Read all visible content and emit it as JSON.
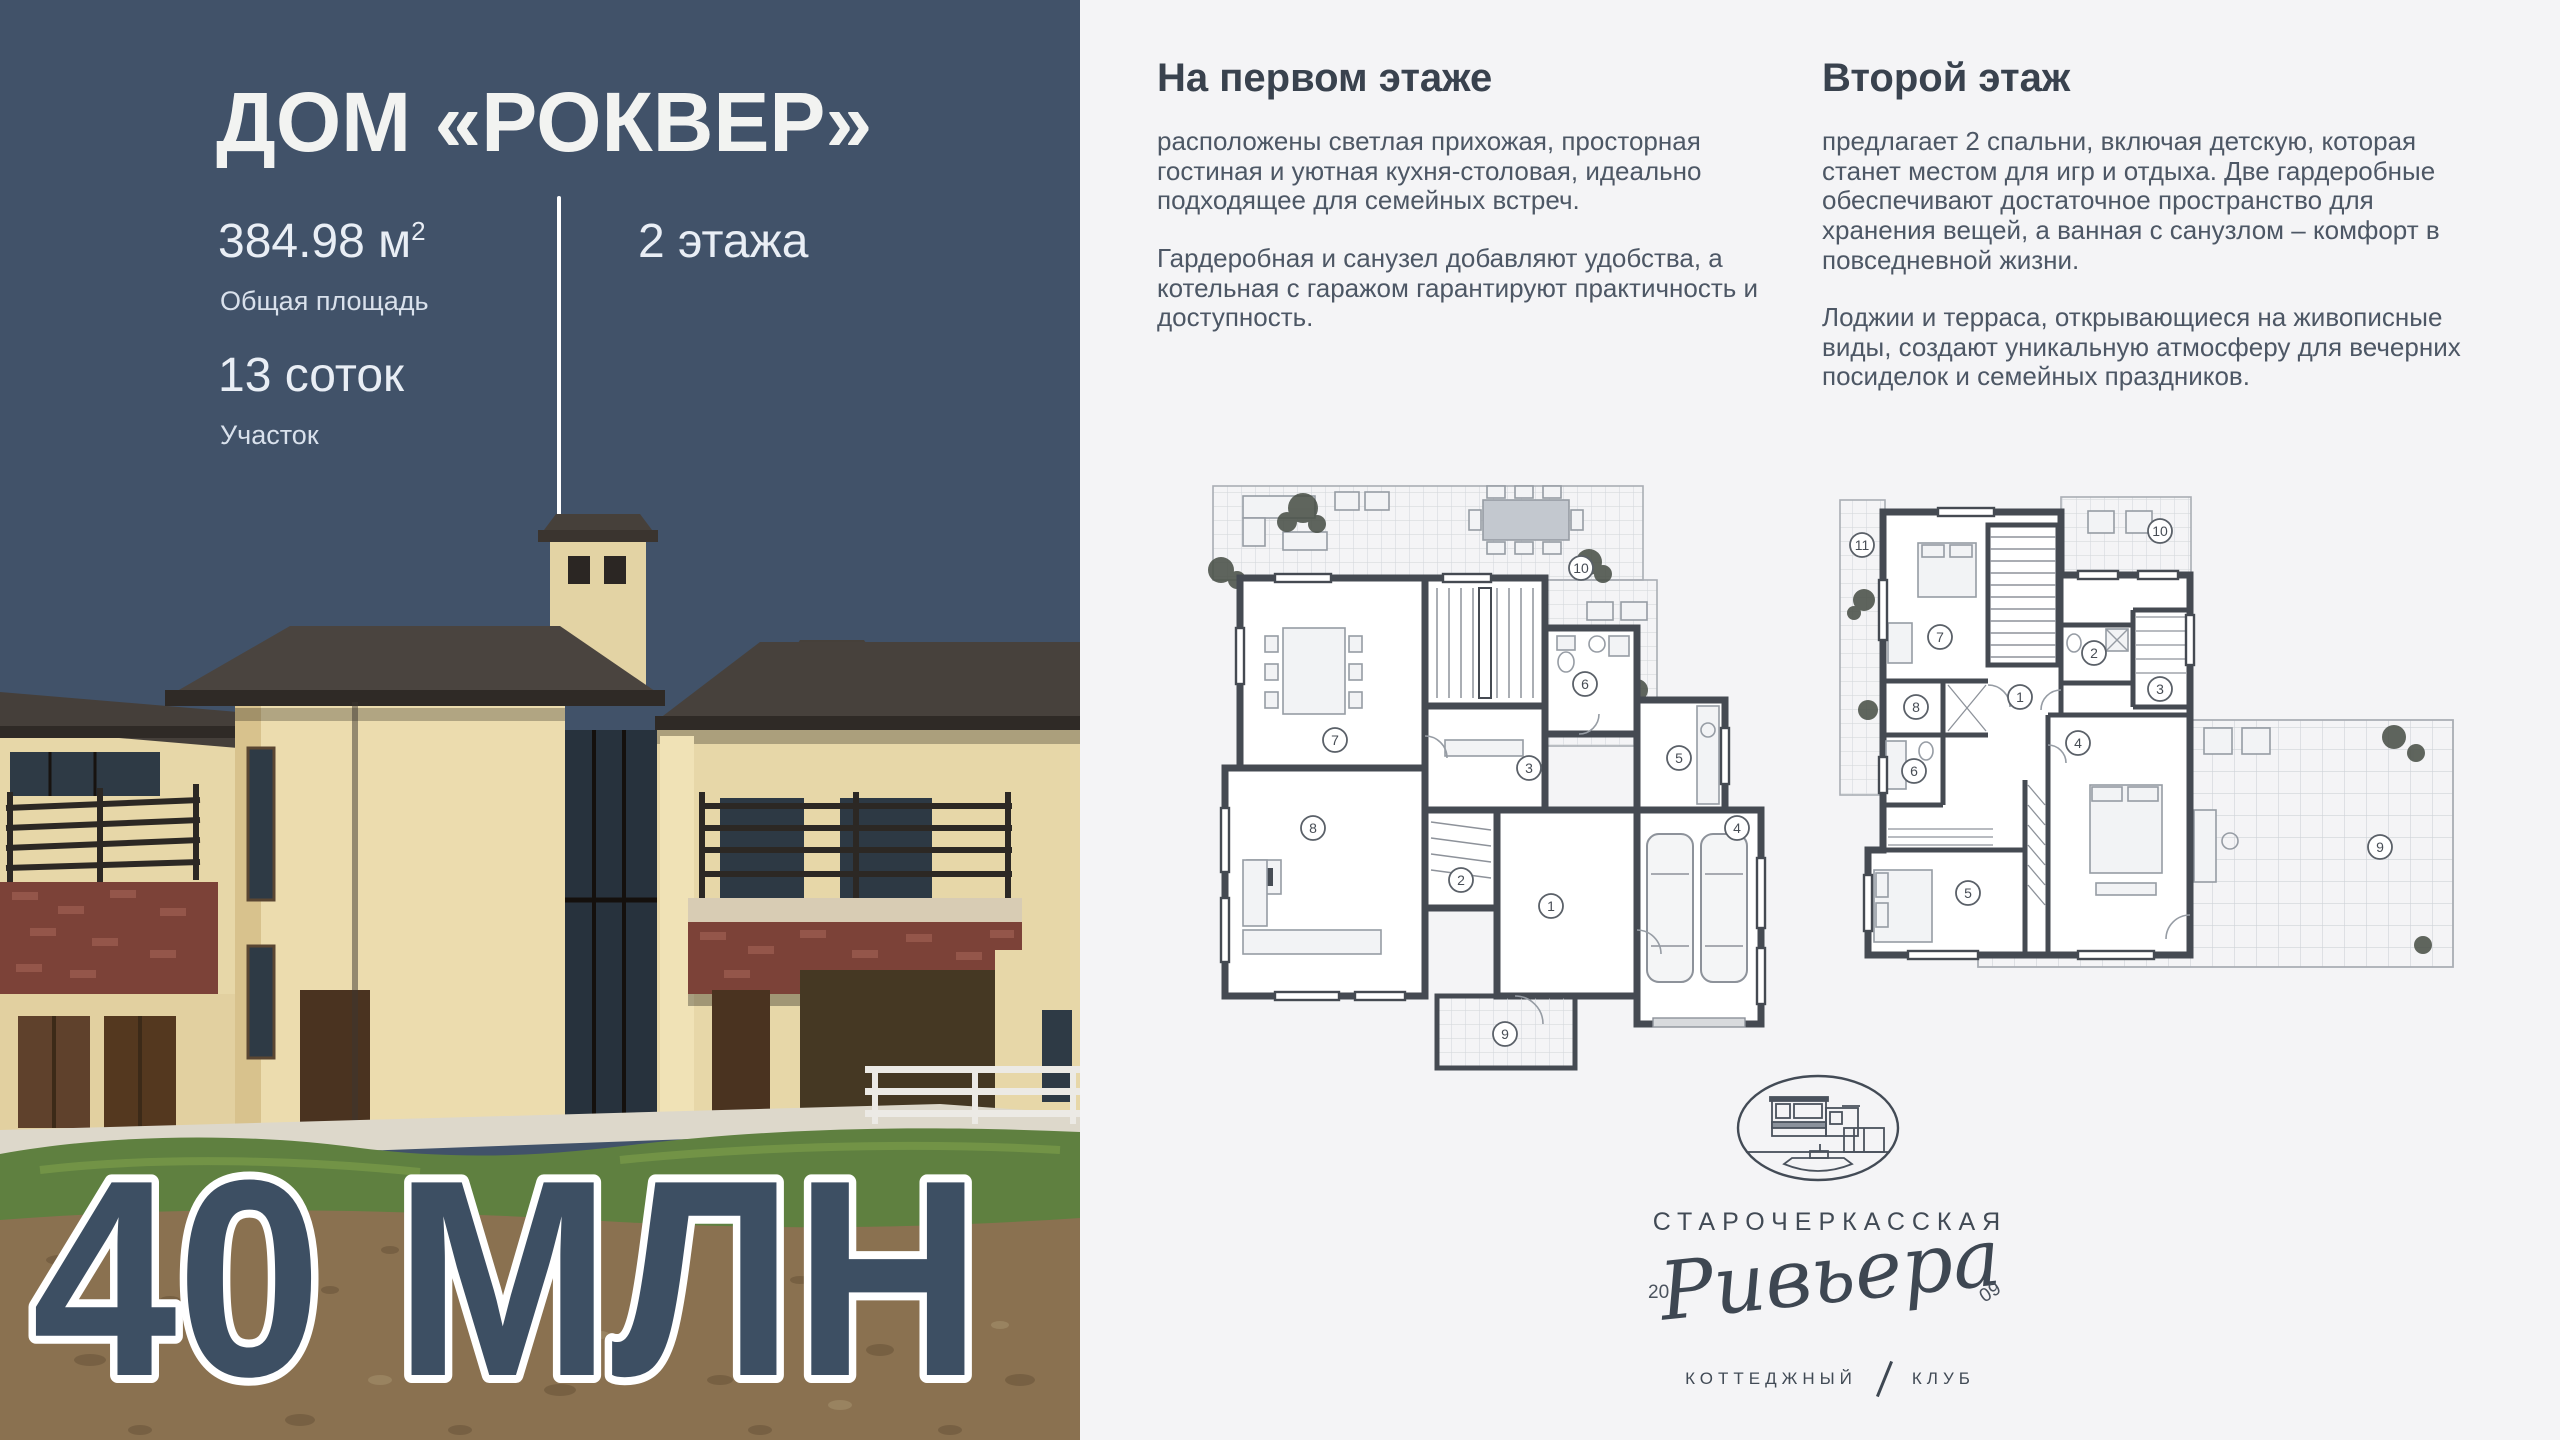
{
  "left_panel": {
    "title": "ДОМ «РОКВЕР»",
    "area_value": "384.98 м",
    "area_sup": "2",
    "area_label": "Общая площадь",
    "floors_value": "2 этажа",
    "plot_value": "13 соток",
    "plot_label": "Участок",
    "price": "40 МЛН"
  },
  "sections": {
    "first_floor": {
      "heading": "На первом этаже",
      "p1": "расположены светлая прихожая, просторная гостиная и уютная кухня-столовая, идеально подходящее для семейных встреч.",
      "p2": "Гардеробная и санузел добавляют удобства, а котельная с гаражом гарантируют практичность и доступность."
    },
    "second_floor": {
      "heading": "Второй этаж",
      "p1": "предлагает 2 спальни, включая детскую, которая станет местом для игр и отдыха. Две гардеробные обеспечивают достаточное пространство для хранения вещей, а ванная с санузлом – комфорт в повседневной жизни.",
      "p2": "Лоджии и терраса, открывающиеся на живописные виды, создают уникальную атмосферу для вечерних посиделок и семейных праздников."
    }
  },
  "plans": {
    "floor1": {
      "rooms": [
        "1",
        "2",
        "3",
        "4",
        "5",
        "6",
        "7",
        "8",
        "9",
        "10"
      ]
    },
    "floor2": {
      "rooms": [
        "1",
        "2",
        "3",
        "4",
        "5",
        "6",
        "7",
        "8",
        "9",
        "10",
        "11"
      ]
    }
  },
  "logo": {
    "estate": "СТАРОЧЕРКАССКАЯ",
    "script": "Ривьера",
    "year_left": "20",
    "year_right": "09",
    "club_left": "КОТТЕДЖНЫЙ",
    "club_right": "КЛУБ"
  },
  "colors": {
    "panel_bg": "#415269",
    "page_bg": "#F4F4F6",
    "price_fill": "#3D4F63",
    "price_stroke": "#FFFFFF",
    "heading": "#39424E",
    "body_text": "#4D5765",
    "plan_wall": "#454A52",
    "house_wall": "#E8D8A9",
    "house_roof": "#47413C",
    "brick_accent": "#7C4238",
    "grass": "#5F8040",
    "dirt": "#8A7150"
  }
}
